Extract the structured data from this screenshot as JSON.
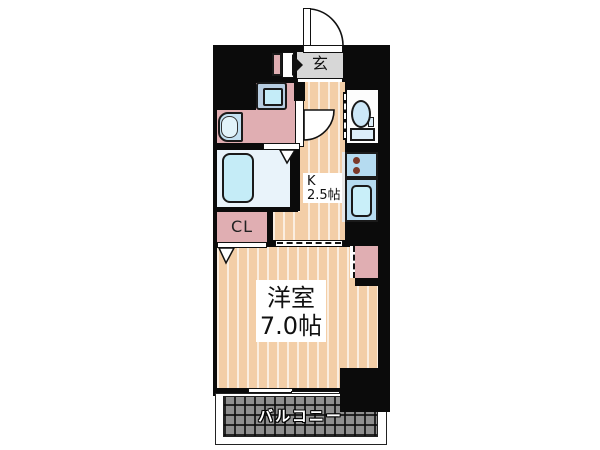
{
  "floorplan": {
    "type": "apartment-1K-floorplan",
    "entrance": {
      "label": "玄"
    },
    "kitchen": {
      "label_line1": "K",
      "label_line2": "2.5帖"
    },
    "closet": {
      "label": "CL"
    },
    "main_room": {
      "label_line1": "洋室",
      "label_line2": "7.0帖"
    },
    "balcony": {
      "label": "バルコニー"
    },
    "fixtures": [
      "entrance-door",
      "shoe-cabinet",
      "washing-machine",
      "wash-basin",
      "bathtub",
      "toilet",
      "kitchen-stove",
      "kitchen-sink",
      "sliding-window"
    ],
    "colors": {
      "wall": "#0b0b0b",
      "flooring": "#f3cea7",
      "flooring_stripe": "#fbe6cc",
      "room_pink": "#e0aeb2",
      "bathroom_blue": "#e9f3fa",
      "fixture_cyan": "#c5ecf7",
      "fixture_panel_blue": "#b5dbf0",
      "entrance_gray": "#d7d7d7",
      "balcony_gray": "#8f8f8f",
      "burner_brown": "#7b3a2a"
    }
  }
}
